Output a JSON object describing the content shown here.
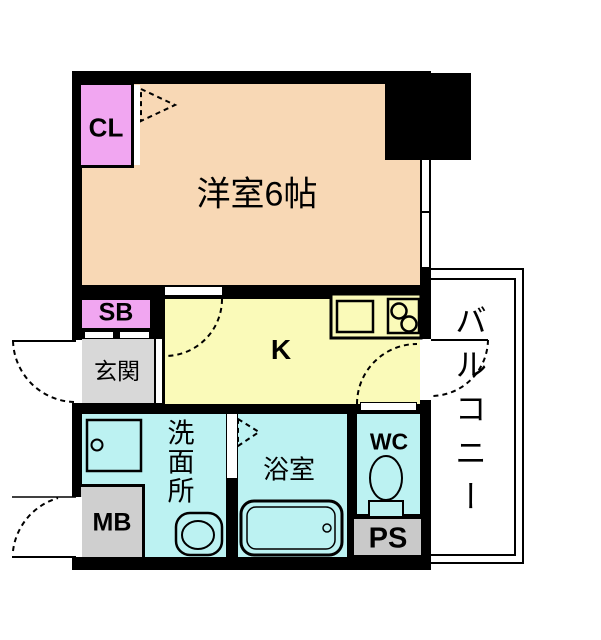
{
  "rooms": {
    "western_room": {
      "label": "洋室6帖"
    },
    "closet": {
      "label": "CL"
    },
    "shoe_box": {
      "label": "SB"
    },
    "entrance": {
      "label": "玄関"
    },
    "kitchen": {
      "label": "K"
    },
    "washroom": {
      "label": "洗面所"
    },
    "bathroom": {
      "label": "浴室"
    },
    "toilet": {
      "label": "WC"
    },
    "meter_box": {
      "label": "MB"
    },
    "pipe_space": {
      "label": "PS"
    },
    "balcony": {
      "label": "バルコニー"
    }
  },
  "colors": {
    "wall": "#000000",
    "western_room": "#F8D8B5",
    "closet_pink": "#F1A6F1",
    "kitchen_yellow": "#FAFAB9",
    "wet_room_cyan": "#BCF2F2",
    "entrance_gray": "#D8D8D8",
    "meter_box_gray": "#CFCFCF",
    "pipe_space_gray": "#C9C9C9",
    "balcony_white": "#FFFFFF"
  }
}
